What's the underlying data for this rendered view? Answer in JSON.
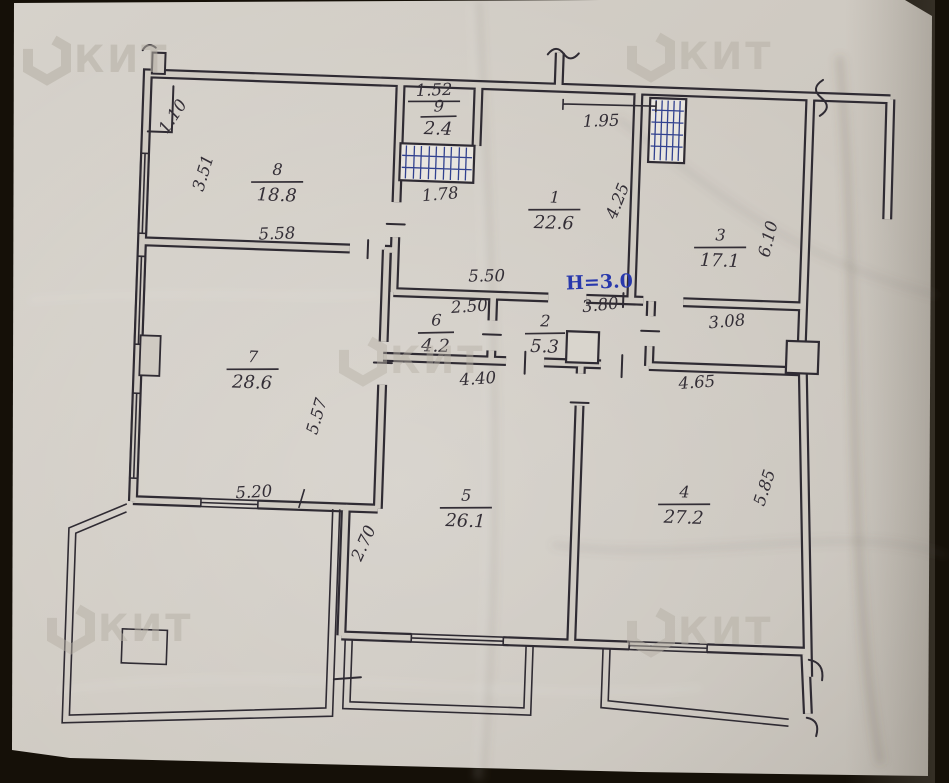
{
  "brand": "КИТ",
  "plan": {
    "height_note": "H=3.0",
    "rooms": [
      {
        "number": "1",
        "area": "22.6"
      },
      {
        "number": "2",
        "area": "5.3"
      },
      {
        "number": "3",
        "area": "17.1"
      },
      {
        "number": "4",
        "area": "27.2"
      },
      {
        "number": "5",
        "area": "26.1"
      },
      {
        "number": "6",
        "area": "4.2"
      },
      {
        "number": "7",
        "area": "28.6"
      },
      {
        "number": "8",
        "area": "18.8"
      },
      {
        "number": "9",
        "area": "2.4"
      }
    ],
    "dims": {
      "d110": "1.10",
      "d152": "1.52",
      "d178": "1.78",
      "d195": "1.95",
      "d250": "2.50",
      "d270": "2.70",
      "d308": "3.08",
      "d351": "3.51",
      "d380": "3.80",
      "d425": "4.25",
      "d440": "4.40",
      "d465": "4.65",
      "d520": "5.20",
      "d550": "5.50",
      "d557": "5.57",
      "d558": "5.58",
      "d585": "5.85",
      "d610": "6.10"
    },
    "colors": {
      "ink": "#2f2b33",
      "height_note_blue": "#2838ac",
      "shaft_hatch_blue": "#31418f",
      "paper": "#cfcac2",
      "photo_background": "#151008",
      "watermark_gray": "#b6b0a5"
    }
  }
}
